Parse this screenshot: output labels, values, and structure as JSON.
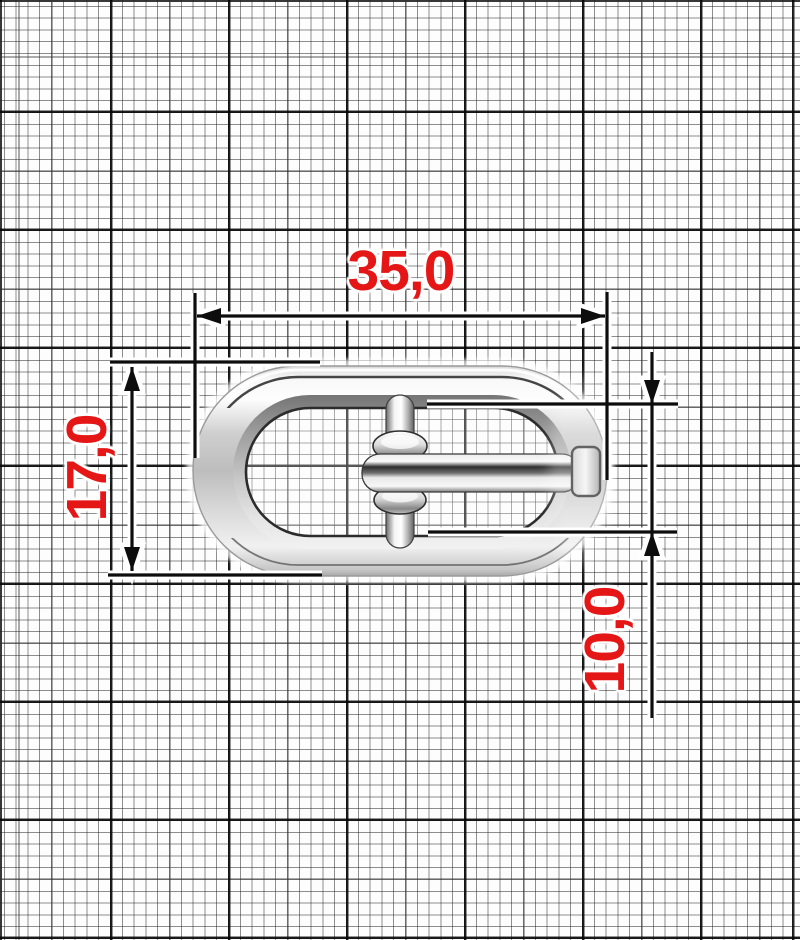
{
  "drawing": {
    "object": "oval-pin-buckle",
    "background": "millimeter-graph-paper",
    "dimensions": {
      "width": {
        "label": "35,0"
      },
      "height": {
        "label": "17,0"
      },
      "pin": {
        "label": "10,0"
      }
    },
    "colors": {
      "dimension_text": "#e41616",
      "dimension_lines": "#0d0d0d",
      "paper": "#fdfdfd",
      "metal_light": "#f7f7f7",
      "metal_mid": "#bfbfbf",
      "metal_dark": "#3a3a3a"
    }
  }
}
